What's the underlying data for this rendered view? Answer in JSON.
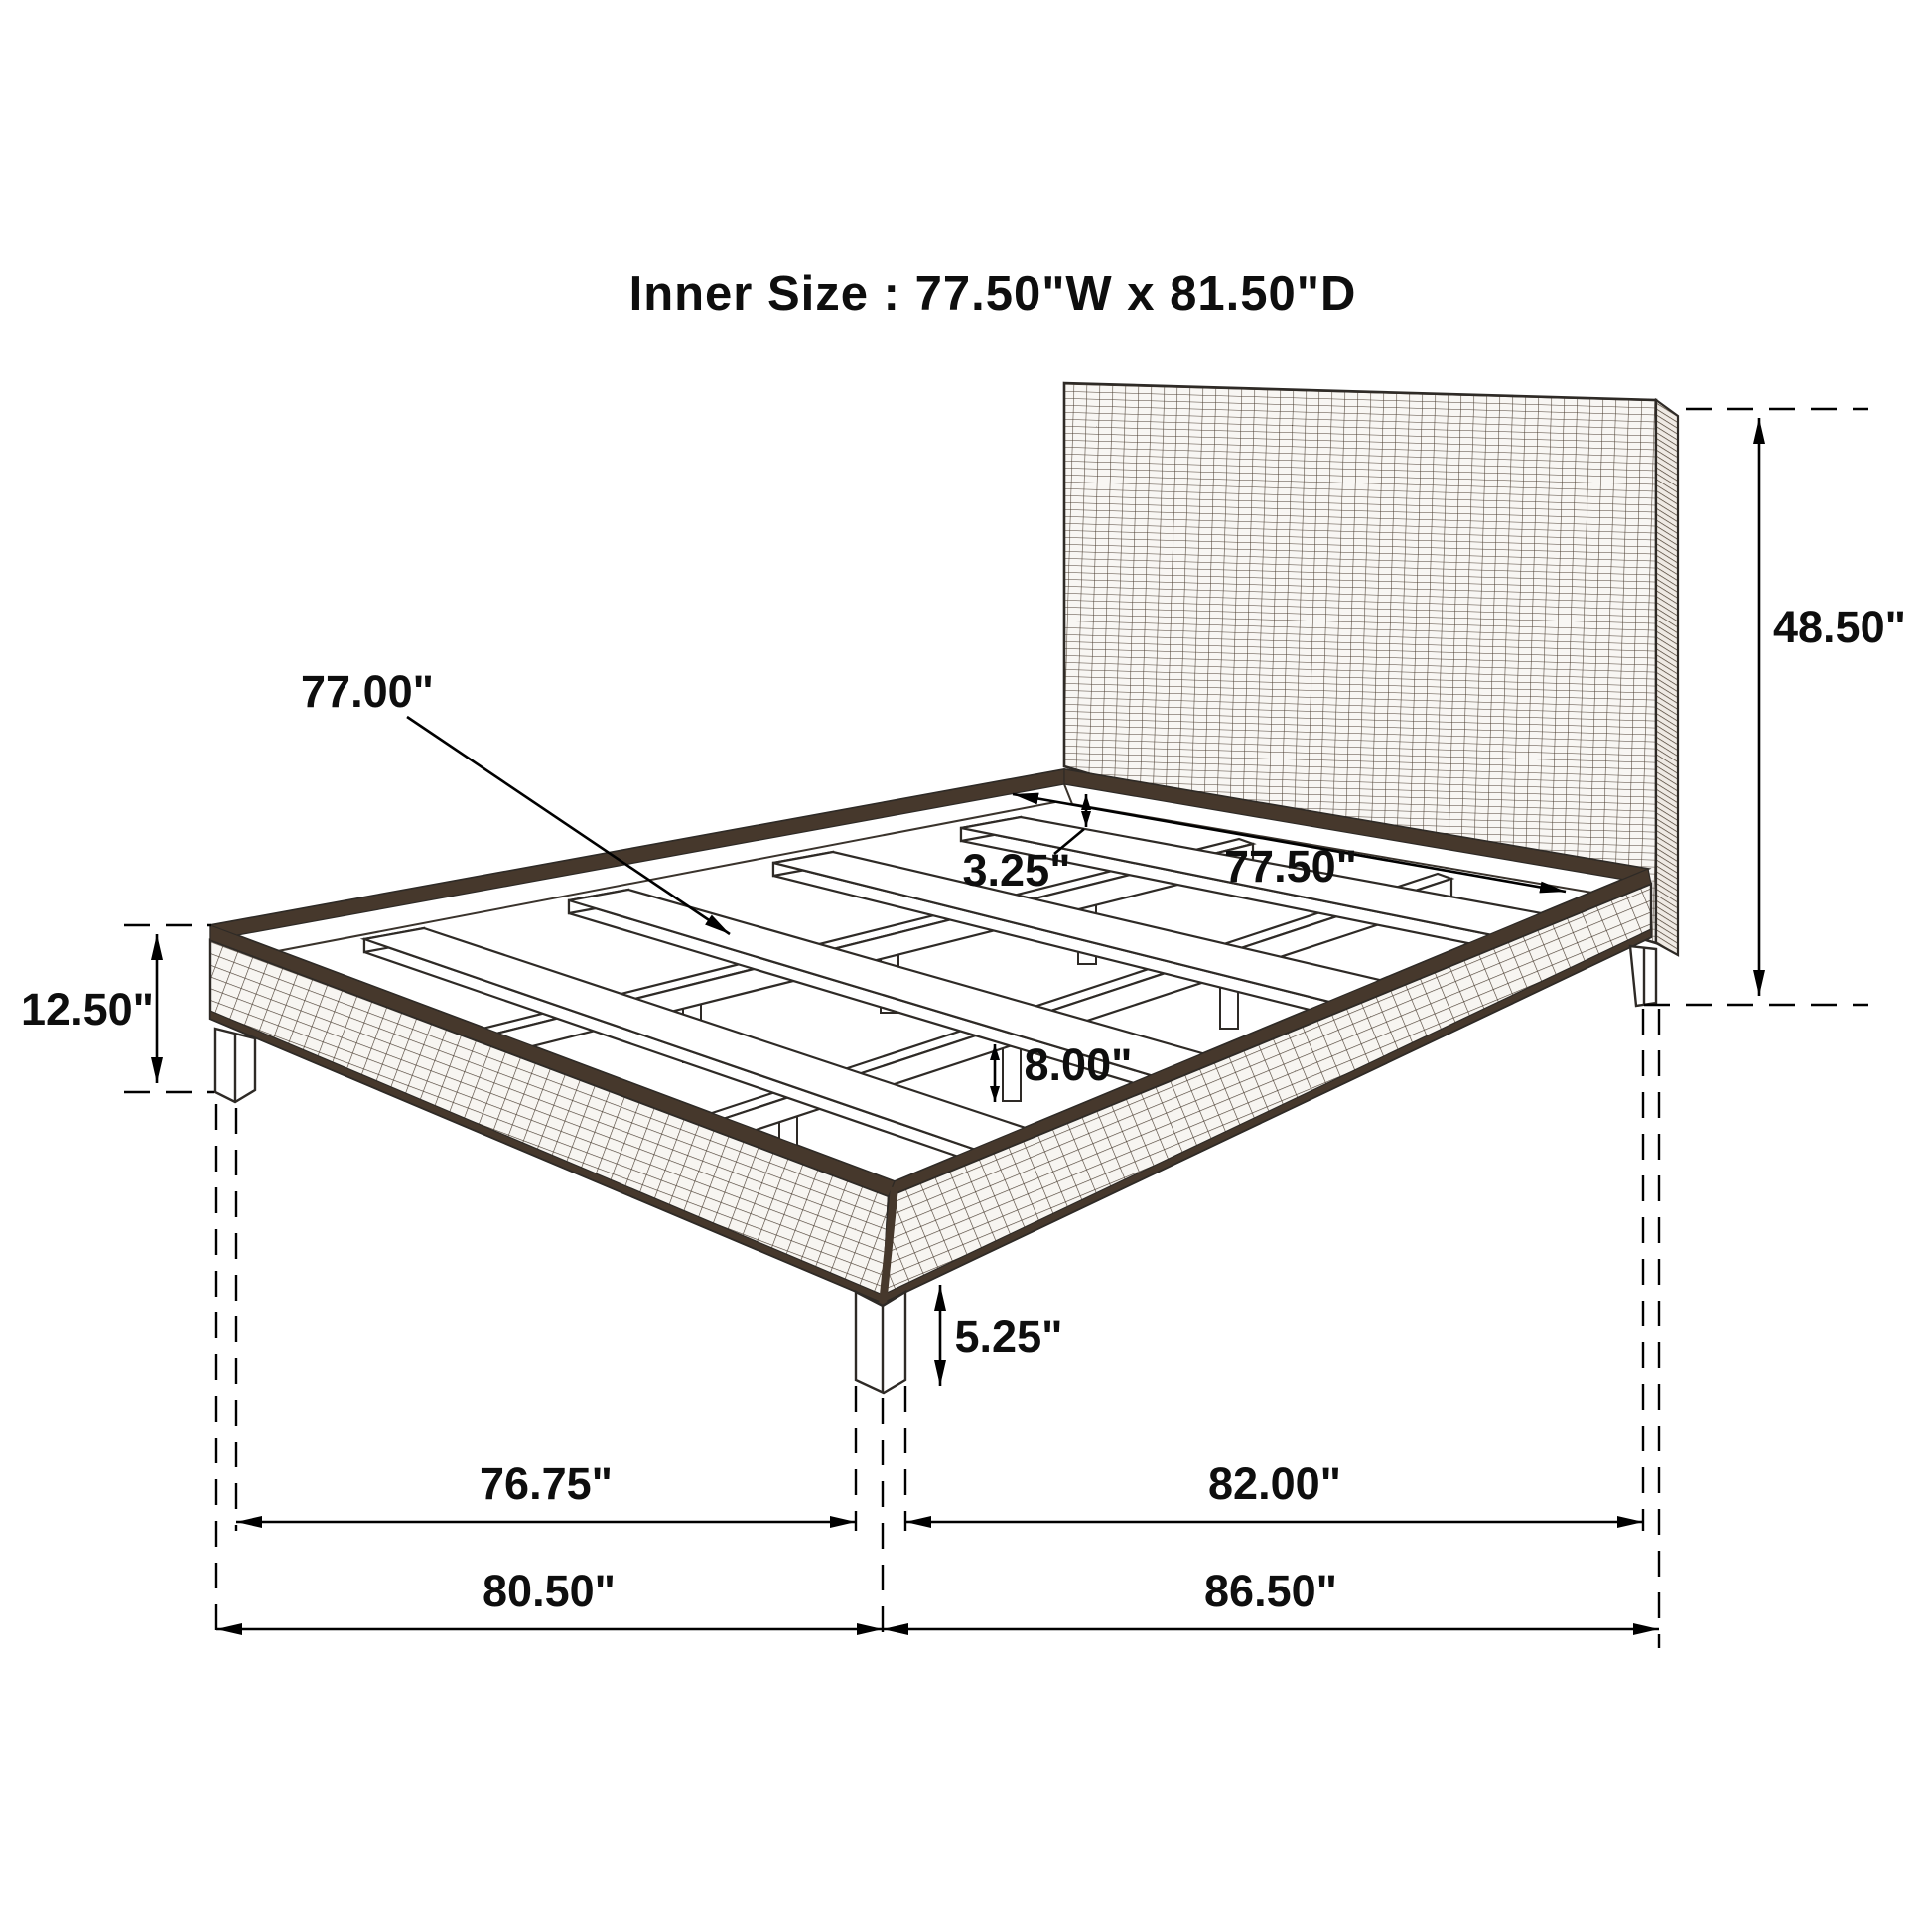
{
  "title": "Inner Size :  77.50\"W x 81.50\"D",
  "dimensions": {
    "slat_length": "77.00\"",
    "inner_width": "77.50\"",
    "slat_recess": "3.25\"",
    "slat_clearance": "8.00\"",
    "frame_height": "12.50\"",
    "headboard_height": "48.50\"",
    "leg_height": "5.25\"",
    "front_leg_span": "76.75\"",
    "side_leg_span": "82.00\"",
    "overall_width": "80.50\"",
    "overall_depth": "86.50\""
  },
  "colors": {
    "background": "#ffffff",
    "linework": "#2e2a26",
    "weave_band": "#46382c",
    "text": "#0e0e0e"
  },
  "figure": "isometric line drawing of a wicker platform bed frame with headboard, two center support rails with posts, and four cross slats, annotated with dimension arrows"
}
